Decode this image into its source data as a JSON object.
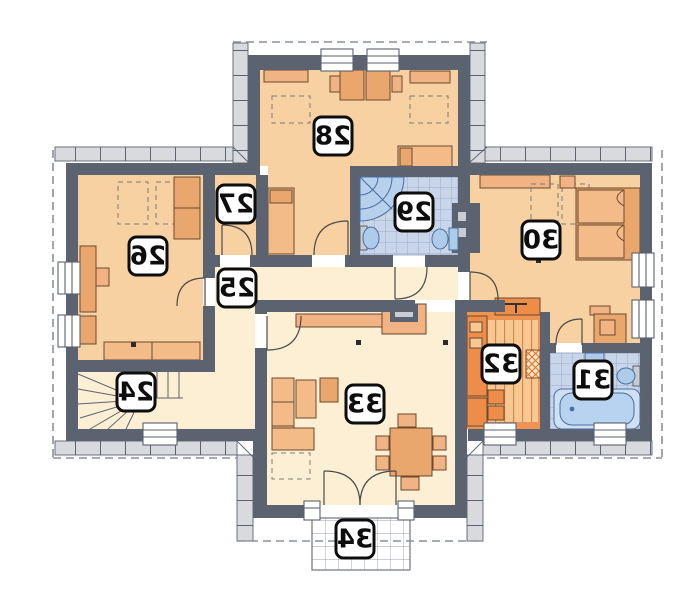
{
  "floor_plan": {
    "orientation": "mirrored",
    "rooms": [
      {
        "number": "24",
        "role": "staircase"
      },
      {
        "number": "25",
        "role": "hall"
      },
      {
        "number": "26",
        "role": "bedroom-left"
      },
      {
        "number": "27",
        "role": "wardrobe-room"
      },
      {
        "number": "28",
        "role": "bedroom-top"
      },
      {
        "number": "29",
        "role": "bathroom-top"
      },
      {
        "number": "30",
        "role": "bedroom-right"
      },
      {
        "number": "31",
        "role": "bathroom-right"
      },
      {
        "number": "32",
        "role": "kitchen"
      },
      {
        "number": "33",
        "role": "living-room"
      },
      {
        "number": "34",
        "role": "terrace"
      }
    ],
    "colors": {
      "wall": "#5b6270",
      "room_peach": "#f7d1a1",
      "room_cream": "#fcefd4",
      "kitchen_orange": "#ee9452",
      "kitchen_floor": "#f7c892",
      "bath_tile": "#c9d5e8",
      "fixture_blue": "#aecbe9",
      "furniture": "#f1b384",
      "band_gray": "#d8dade",
      "roof_dash": "#8a8f98"
    }
  }
}
